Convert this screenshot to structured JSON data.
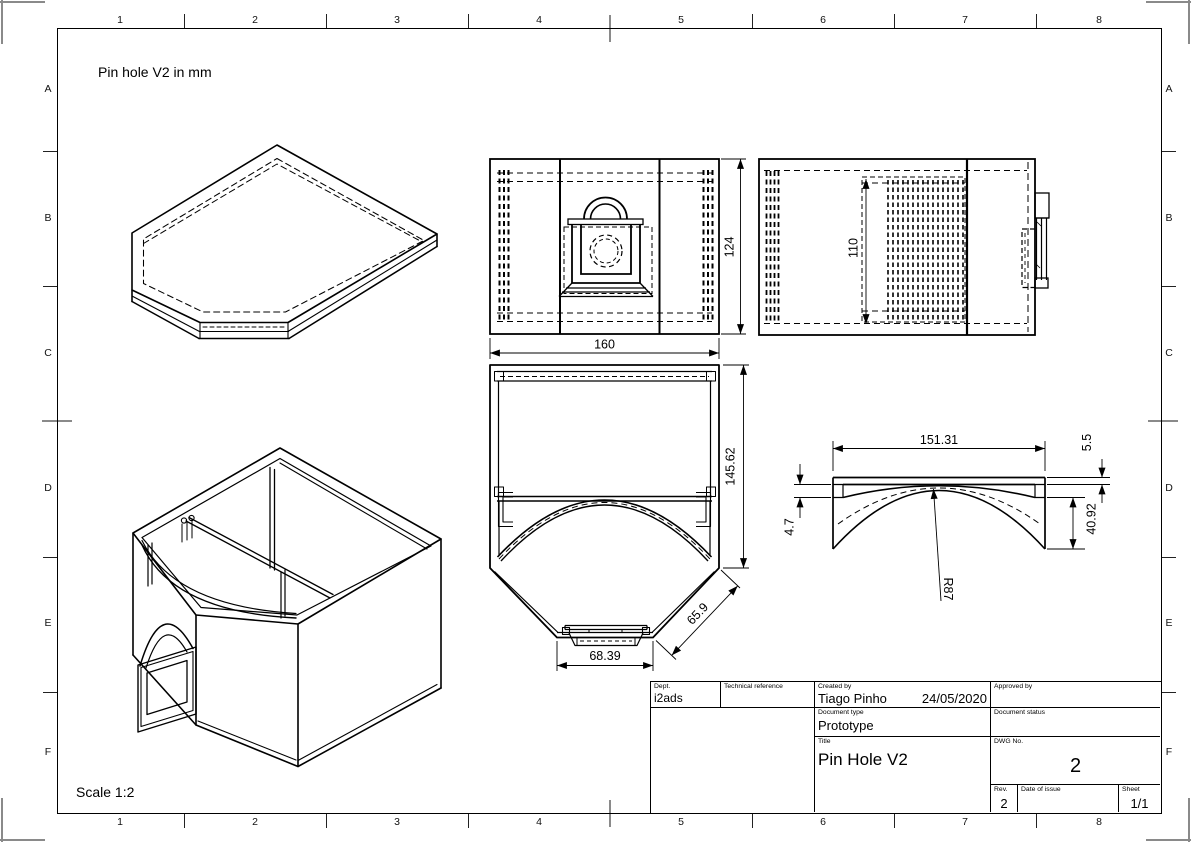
{
  "sheet": {
    "note": "Pin hole V2 in mm",
    "scale_label": "Scale 1:2"
  },
  "grid": {
    "columns": [
      "1",
      "2",
      "3",
      "4",
      "5",
      "6",
      "7",
      "8"
    ],
    "rows": [
      "A",
      "B",
      "C",
      "D",
      "E",
      "F"
    ]
  },
  "dimensions": {
    "front_height": "124",
    "front_width": "160",
    "side_inner_height": "110",
    "plan_height": "145.62",
    "plan_chamfer": "65.9",
    "plan_bottom_width": "68.39",
    "arch_width": "151.31",
    "arch_top_thickness": "5.5",
    "arch_step": "4.7",
    "arch_end_height": "40.92",
    "arch_radius": "R87"
  },
  "title_block": {
    "dept_label": "Dept.",
    "dept_value": "i2ads",
    "technical_reference_label": "Technical reference",
    "created_by_label": "Created by",
    "created_by_value": "Tiago Pinho",
    "created_date": "24/05/2020",
    "approved_by_label": "Approved by",
    "document_type_label": "Document type",
    "document_type_value": "Prototype",
    "document_status_label": "Document status",
    "title_label": "Title",
    "title_value": "Pin Hole V2",
    "dwg_label": "DWG No.",
    "dwg_value": "2",
    "rev_label": "Rev.",
    "rev_value": "2",
    "date_of_issue_label": "Date of issue",
    "sheet_label": "Sheet",
    "sheet_value": "1/1"
  }
}
